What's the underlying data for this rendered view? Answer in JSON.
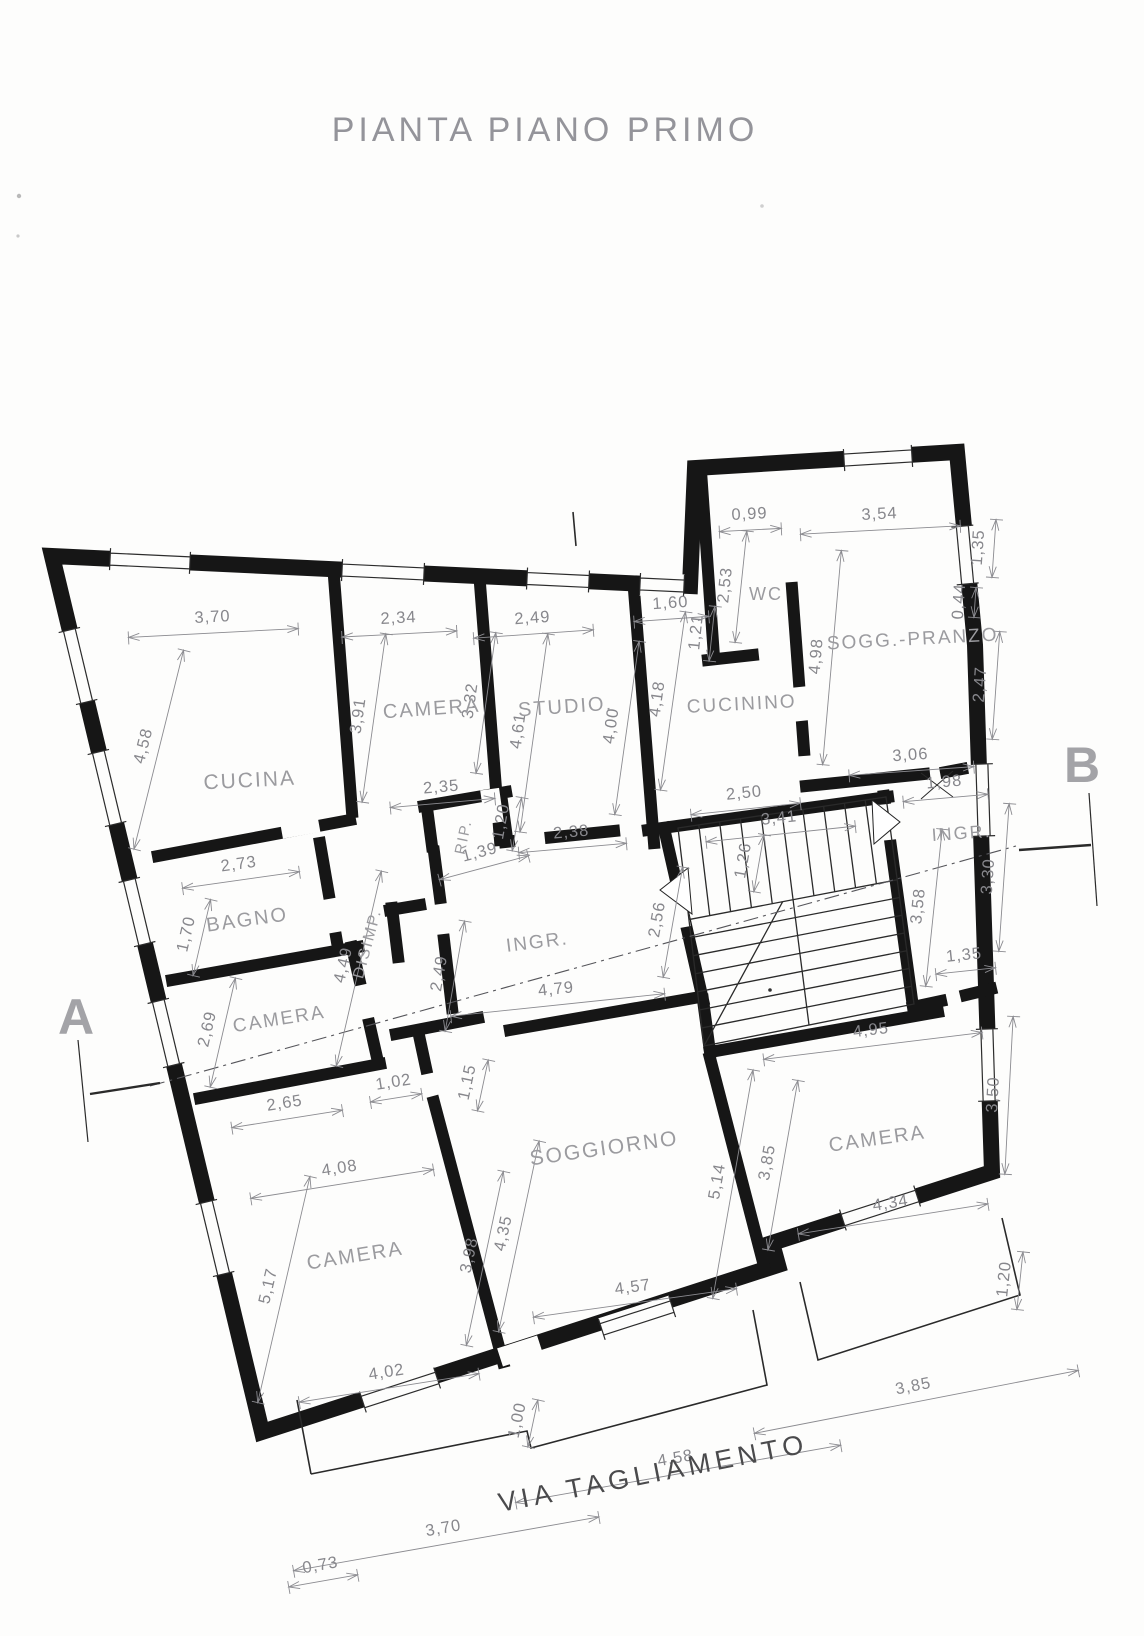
{
  "title": "PIANTA PIANO PRIMO",
  "street": "VIA TAGLIAMENTO",
  "section_markers": {
    "a": "A",
    "b": "B"
  },
  "rooms": [
    {
      "label": "CUCINA",
      "x": 250,
      "y": 787,
      "r": -3,
      "size": 21
    },
    {
      "label": "CAMERA",
      "x": 432,
      "y": 715,
      "r": -4,
      "size": 20
    },
    {
      "label": "STUDIO.",
      "x": 566,
      "y": 713,
      "r": -4,
      "size": 20
    },
    {
      "label": "CUCININO",
      "x": 742,
      "y": 710,
      "r": -3,
      "size": 19
    },
    {
      "label": "WC",
      "x": 766,
      "y": 600,
      "r": 0,
      "size": 18
    },
    {
      "label": "SOGG.-PRANZO",
      "x": 913,
      "y": 645,
      "r": -3,
      "size": 19
    },
    {
      "label": "BAGNO",
      "x": 248,
      "y": 926,
      "r": -8,
      "size": 20
    },
    {
      "label": "DISIMP.",
      "x": 372,
      "y": 945,
      "r": -75,
      "size": 16
    },
    {
      "label": "RIP.",
      "x": 468,
      "y": 838,
      "r": -78,
      "size": 15
    },
    {
      "label": "INGR.",
      "x": 538,
      "y": 948,
      "r": -7,
      "size": 19
    },
    {
      "label": "INGR.",
      "x": 962,
      "y": 839,
      "r": -4,
      "size": 18
    },
    {
      "label": "CAMERA",
      "x": 280,
      "y": 1025,
      "r": -9,
      "size": 19
    },
    {
      "label": "CAMERA",
      "x": 356,
      "y": 1262,
      "r": -9,
      "size": 20
    },
    {
      "label": "SOGGIORNO",
      "x": 605,
      "y": 1155,
      "r": -8,
      "size": 21
    },
    {
      "label": "CAMERA",
      "x": 878,
      "y": 1145,
      "r": -8,
      "size": 20
    }
  ],
  "dimensions": [
    {
      "t": "3,70",
      "x": 213,
      "y": 626,
      "r": -3,
      "len": 170
    },
    {
      "t": "2,34",
      "x": 399,
      "y": 627,
      "r": -3,
      "len": 115
    },
    {
      "t": "2,49",
      "x": 533,
      "y": 627,
      "r": -4,
      "len": 120
    },
    {
      "t": "1,60",
      "x": 671,
      "y": 612,
      "r": -4,
      "len": 75
    },
    {
      "t": "0,99",
      "x": 750,
      "y": 523,
      "r": -3,
      "len": 62
    },
    {
      "t": "3,54",
      "x": 880,
      "y": 523,
      "r": -3,
      "len": 160
    },
    {
      "t": "1,35",
      "x": 987,
      "y": 548,
      "r": -86,
      "len": 58
    },
    {
      "t": "0,44",
      "x": 968,
      "y": 602,
      "r": -86,
      "len": 30
    },
    {
      "t": "2,53",
      "x": 734,
      "y": 586,
      "r": -84,
      "len": 112
    },
    {
      "t": "1,21",
      "x": 705,
      "y": 633,
      "r": -84,
      "len": 55
    },
    {
      "t": "4,98",
      "x": 825,
      "y": 657,
      "r": -85,
      "len": 215
    },
    {
      "t": "2,47",
      "x": 989,
      "y": 685,
      "r": -86,
      "len": 108
    },
    {
      "t": "4,18",
      "x": 666,
      "y": 700,
      "r": -82,
      "len": 180
    },
    {
      "t": "3,91",
      "x": 367,
      "y": 717,
      "r": -82,
      "len": 170
    },
    {
      "t": "3,32",
      "x": 479,
      "y": 702,
      "r": -82,
      "len": 142
    },
    {
      "t": "4,61",
      "x": 527,
      "y": 732,
      "r": -82,
      "len": 200
    },
    {
      "t": "4,00",
      "x": 620,
      "y": 727,
      "r": -82,
      "len": 175
    },
    {
      "t": "4,58",
      "x": 152,
      "y": 748,
      "r": -76,
      "len": 205
    },
    {
      "t": "2,35",
      "x": 442,
      "y": 796,
      "r": -5,
      "len": 105
    },
    {
      "t": "3,06",
      "x": 911,
      "y": 764,
      "r": -4,
      "len": 125
    },
    {
      "t": "1,98",
      "x": 945,
      "y": 791,
      "r": -5,
      "len": 85
    },
    {
      "t": "2,50",
      "x": 745,
      "y": 802,
      "r": -6,
      "len": 110
    },
    {
      "t": "3,41",
      "x": 780,
      "y": 827,
      "r": -6,
      "len": 150
    },
    {
      "t": "1,26",
      "x": 752,
      "y": 862,
      "r": -80,
      "len": 58
    },
    {
      "t": "1,39",
      "x": 482,
      "y": 861,
      "r": -15,
      "len": 92
    },
    {
      "t": "1,20",
      "x": 510,
      "y": 823,
      "r": -80,
      "len": 54
    },
    {
      "t": "2,38",
      "x": 572,
      "y": 841,
      "r": -5,
      "len": 108
    },
    {
      "t": "2,73",
      "x": 240,
      "y": 873,
      "r": -8,
      "len": 118
    },
    {
      "t": "1,70",
      "x": 195,
      "y": 936,
      "r": -77,
      "len": 78
    },
    {
      "t": "4,49",
      "x": 352,
      "y": 967,
      "r": -77,
      "len": 200
    },
    {
      "t": "2,49",
      "x": 448,
      "y": 975,
      "r": -80,
      "len": 112
    },
    {
      "t": "2,56",
      "x": 666,
      "y": 921,
      "r": -80,
      "len": 112
    },
    {
      "t": "3,58",
      "x": 927,
      "y": 907,
      "r": -84,
      "len": 158
    },
    {
      "t": "3,30",
      "x": 997,
      "y": 877,
      "r": -86,
      "len": 148
    },
    {
      "t": "2,69",
      "x": 216,
      "y": 1031,
      "r": -77,
      "len": 112
    },
    {
      "t": "4,79",
      "x": 557,
      "y": 998,
      "r": -6,
      "len": 215
    },
    {
      "t": "1,35",
      "x": 965,
      "y": 964,
      "r": -6,
      "len": 60
    },
    {
      "t": "4,95",
      "x": 872,
      "y": 1039,
      "r": -7,
      "len": 220
    },
    {
      "t": "2,65",
      "x": 286,
      "y": 1112,
      "r": -9,
      "len": 112
    },
    {
      "t": "1,02",
      "x": 395,
      "y": 1091,
      "r": -9,
      "len": 52
    },
    {
      "t": "1,15",
      "x": 476,
      "y": 1084,
      "r": -78,
      "len": 52
    },
    {
      "t": "3,50",
      "x": 1002,
      "y": 1095,
      "r": -87,
      "len": 158
    },
    {
      "t": "3,85",
      "x": 776,
      "y": 1164,
      "r": -80,
      "len": 172
    },
    {
      "t": "5,14",
      "x": 726,
      "y": 1183,
      "r": -80,
      "len": 232
    },
    {
      "t": "4,08",
      "x": 341,
      "y": 1177,
      "r": -9,
      "len": 185
    },
    {
      "t": "4,35",
      "x": 512,
      "y": 1235,
      "r": -78,
      "len": 195
    },
    {
      "t": "3,98",
      "x": 478,
      "y": 1257,
      "r": -78,
      "len": 178
    },
    {
      "t": "5,17",
      "x": 277,
      "y": 1288,
      "r": -77,
      "len": 232
    },
    {
      "t": "4,34",
      "x": 892,
      "y": 1212,
      "r": -9,
      "len": 192
    },
    {
      "t": "4,57",
      "x": 634,
      "y": 1296,
      "r": -8,
      "len": 205
    },
    {
      "t": "1,20",
      "x": 1013,
      "y": 1280,
      "r": -84,
      "len": 58
    },
    {
      "t": "4,02",
      "x": 388,
      "y": 1381,
      "r": -9,
      "len": 182
    },
    {
      "t": "1,00",
      "x": 526,
      "y": 1422,
      "r": -78,
      "len": 48
    },
    {
      "t": "3,85",
      "x": 915,
      "y": 1395,
      "r": -11,
      "len": 330
    },
    {
      "t": "4,58",
      "x": 677,
      "y": 1467,
      "r": -10,
      "len": 330
    },
    {
      "t": "3,70",
      "x": 445,
      "y": 1537,
      "r": -10,
      "len": 310
    },
    {
      "t": "0,73",
      "x": 322,
      "y": 1574,
      "r": -10,
      "len": 70
    }
  ]
}
